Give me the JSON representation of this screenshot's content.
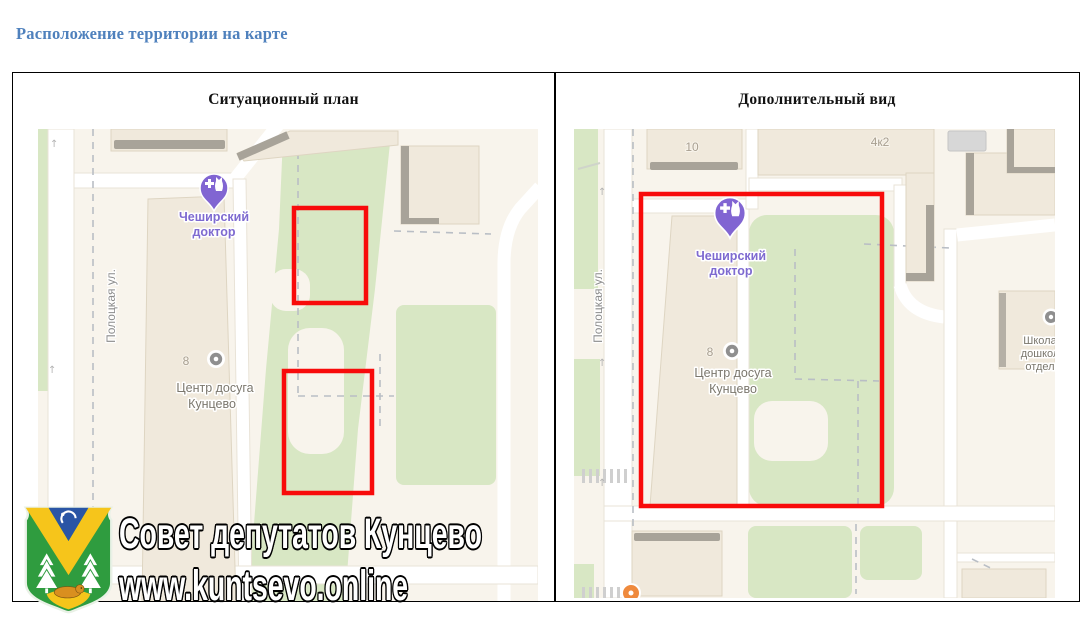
{
  "page": {
    "title": "Расположение территории на карте"
  },
  "colors": {
    "title_blue": "#4f81bd",
    "highlight_red": "#f80b0b",
    "map_background": "#f8f4ec",
    "map_green": "#d8e7c4",
    "building_fill": "#f0e9dc",
    "building_shadow": "#a8a399",
    "road_white": "#ffffff",
    "poi_purple": "#8165d2",
    "map_label_gray": "#7b776d",
    "street_label_gray": "#8c8c8c"
  },
  "panels": [
    {
      "title": "Ситуационный план",
      "map": {
        "street_label": "Полоцкая ул.",
        "house_number": "8",
        "vet_poi": {
          "line1": "Чеширский",
          "line2": "доктор"
        },
        "leisure_poi": {
          "line1": "Центр досуга",
          "line2": "Кунцево"
        }
      }
    },
    {
      "title": "Дополнительный вид",
      "map": {
        "street_label": "Полоцкая ул.",
        "house_number": "8",
        "building_10": "10",
        "building_4k2": "4к2",
        "vet_poi": {
          "line1": "Чеширский",
          "line2": "доктор"
        },
        "leisure_poi": {
          "line1": "Центр досуга",
          "line2": "Кунцево"
        },
        "school_poi": {
          "line1": "Школа",
          "line2": "дошкол",
          "line3": "отдел"
        }
      }
    }
  ],
  "watermark": {
    "line1": "Совет депутатов Кунцево",
    "line2": "www.kuntsevo.online",
    "emblem": "kuntsevo-district-coat-of-arms"
  }
}
